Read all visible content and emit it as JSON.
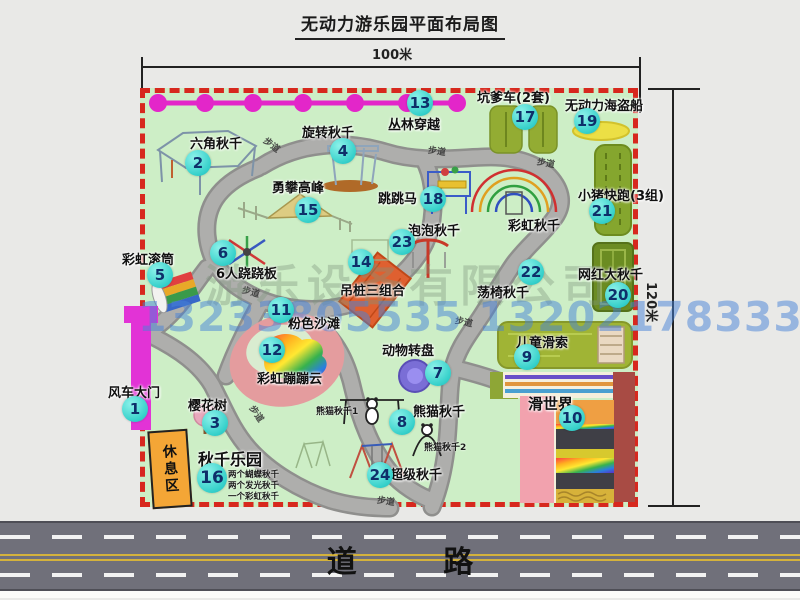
{
  "title": "无动力游乐园平面布局图",
  "dimensions": {
    "width_label": "100米",
    "height_label": "120米"
  },
  "road": {
    "label": "道 路"
  },
  "rest_area": {
    "label": "休息区"
  },
  "path_label": "步道",
  "watermark": {
    "company": "游乐设备有限公司",
    "phone": "13233805535 13202178333"
  },
  "colors": {
    "marker": "#35d0ca",
    "border-red": "#d7281e",
    "park-green": "#cdeec6",
    "magenta": "#e233d6",
    "rest-orange": "#f4a636",
    "road-gray": "#70707a"
  },
  "attractions": [
    {
      "num": "1",
      "name": "风车大门"
    },
    {
      "num": "2",
      "name": "六角秋千"
    },
    {
      "num": "3",
      "name": "樱花树"
    },
    {
      "num": "4",
      "name": "旋转秋千"
    },
    {
      "num": "5",
      "name": "彩虹滚筒"
    },
    {
      "num": "6",
      "name": "6人跷跷板"
    },
    {
      "num": "7",
      "name": "动物转盘"
    },
    {
      "num": "8",
      "name": "熊猫秋千"
    },
    {
      "num": "9",
      "name": "儿童滑索"
    },
    {
      "num": "10",
      "name": "滑世界"
    },
    {
      "num": "11",
      "name": "粉色沙滩"
    },
    {
      "num": "12",
      "name": "彩虹蹦蹦云"
    },
    {
      "num": "13",
      "name": "丛林穿越"
    },
    {
      "num": "14",
      "name": "吊桩三组合"
    },
    {
      "num": "15",
      "name": "勇攀高峰"
    },
    {
      "num": "16",
      "name": "秋千乐园"
    },
    {
      "num": "17",
      "name": "坑爹车(2套)"
    },
    {
      "num": "18",
      "name": "跳跳马"
    },
    {
      "num": "19",
      "name": "无动力海盗船"
    },
    {
      "num": "20",
      "name": "网红大秋千"
    },
    {
      "num": "21",
      "name": "小猪快跑(3组)"
    },
    {
      "num": "22",
      "name": "荡椅秋千"
    },
    {
      "num": "23",
      "name": "泡泡秋千"
    },
    {
      "num": "24",
      "name": "超级秋千"
    }
  ],
  "extra_labels": {
    "rainbow_swing": "彩虹秋千",
    "panda1": "熊猫秋千1",
    "panda2": "熊猫秋千2"
  },
  "swing_park_details": [
    "两个蝴蝶秋千",
    "两个发光秋千",
    "一个彩虹秋千"
  ]
}
